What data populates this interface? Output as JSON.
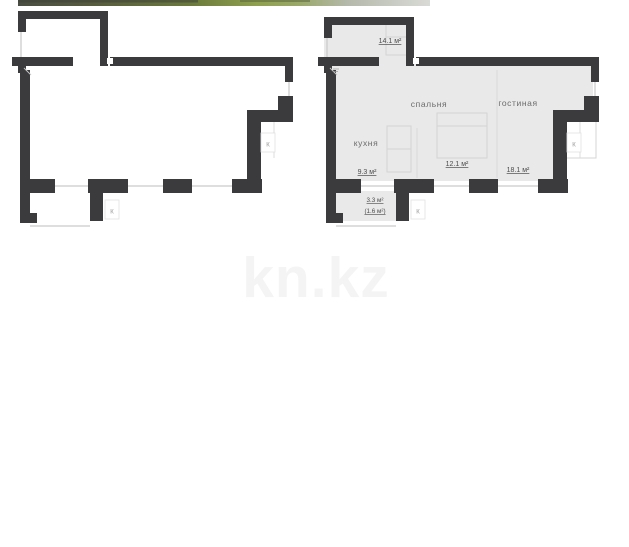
{
  "watermark": {
    "text": "kn.kz"
  },
  "colors": {
    "wall": "#3b3b3e",
    "room_fill": "#e9e9e9",
    "window_line": "#c9c9c9",
    "label_text": "#4c4c4c",
    "room_name_text": "#6b6b6b",
    "watermark_text": "#f4f4f4",
    "photo_strip_tones": [
      "#4a4e42",
      "#575c3d",
      "#6b7a3a",
      "#8fa04f",
      "#9aa868",
      "#b4b9ab",
      "#d9dad6"
    ]
  },
  "plans": {
    "left": {
      "title": "outline-floor-plan",
      "k_markers": [
        "К",
        "К"
      ]
    },
    "right": {
      "title": "furnished-floor-plan",
      "rooms": [
        {
          "label": "",
          "area": "14.1 м²"
        },
        {
          "label": "кухня",
          "area": "9.3 м²"
        },
        {
          "label": "спальня",
          "area": "12.1 м²"
        },
        {
          "label": "гостиная",
          "area": "18.1 м²"
        },
        {
          "label": "",
          "area": "3.3 м²",
          "area_secondary": "(1.6 м²)"
        }
      ],
      "k_markers": [
        "К",
        "К"
      ]
    }
  }
}
